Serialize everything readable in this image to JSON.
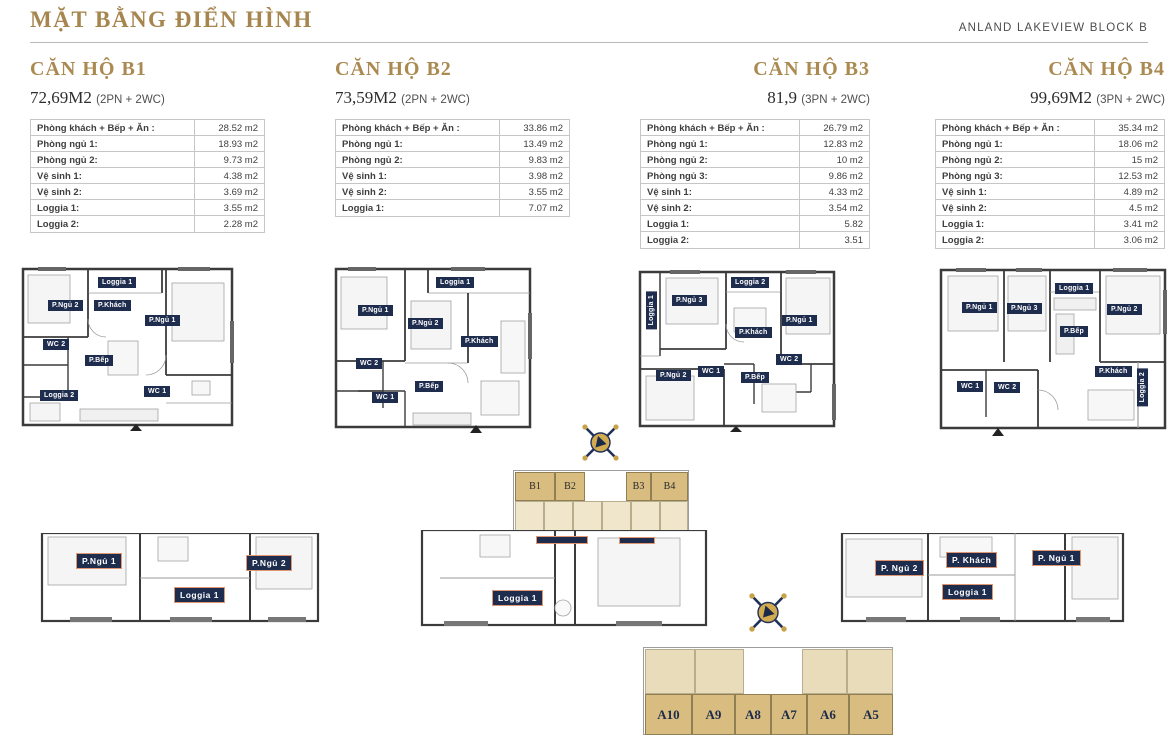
{
  "header": {
    "title": "MẶT BẰNG ĐIỂN HÌNH",
    "block_label": "ANLAND LAKEVIEW BLOCK B"
  },
  "colors": {
    "heading_gold": "#a6854e",
    "label_navy": "#1e2c4e",
    "keyplan_tan": "#d9bd80",
    "keyplan_pale": "#efe6cb"
  },
  "apartments": [
    {
      "name": "CĂN HỘ B1",
      "area": "72,69M2",
      "config": "(2PN + 2WC)",
      "rows": [
        {
          "label": "Phòng khách + Bếp + Ăn :",
          "value": "28.52 m2"
        },
        {
          "label": "Phòng ngủ 1:",
          "value": "18.93 m2"
        },
        {
          "label": "Phòng ngủ 2:",
          "value": "9.73 m2"
        },
        {
          "label": "Vệ sinh 1:",
          "value": "4.38 m2"
        },
        {
          "label": "Vệ sinh 2:",
          "value": "3.69 m2"
        },
        {
          "label": "Loggia 1:",
          "value": "3.55 m2"
        },
        {
          "label": "Loggia 2:",
          "value": "2.28 m2"
        }
      ]
    },
    {
      "name": "CĂN HỘ B2",
      "area": "73,59M2",
      "config": "(2PN + 2WC)",
      "rows": [
        {
          "label": "Phòng khách + Bếp + Ăn :",
          "value": "33.86 m2"
        },
        {
          "label": "Phòng ngủ 1:",
          "value": "13.49 m2"
        },
        {
          "label": "Phòng ngủ 2:",
          "value": "9.83 m2"
        },
        {
          "label": "Vệ sinh 1:",
          "value": "3.98 m2"
        },
        {
          "label": "Vệ sinh 2:",
          "value": "3.55 m2"
        },
        {
          "label": "Loggia 1:",
          "value": "7.07 m2"
        }
      ]
    },
    {
      "name": "CĂN HỘ B3",
      "area": "81,9",
      "config": "(3PN + 2WC)",
      "rows": [
        {
          "label": "Phòng khách + Bếp + Ăn :",
          "value": "26.79 m2"
        },
        {
          "label": "Phòng ngủ 1:",
          "value": "12.83 m2"
        },
        {
          "label": "Phòng ngủ 2:",
          "value": "10 m2"
        },
        {
          "label": "Phòng ngủ 3:",
          "value": "9.86 m2"
        },
        {
          "label": "Vệ sinh 1:",
          "value": "4.33 m2"
        },
        {
          "label": "Vệ sinh 2:",
          "value": "3.54 m2"
        },
        {
          "label": "Loggia 1:",
          "value": "5.82"
        },
        {
          "label": "Loggia 2:",
          "value": "3.51"
        }
      ]
    },
    {
      "name": "CĂN HỘ B4",
      "area": "99,69M2",
      "config": "(3PN + 2WC)",
      "rows": [
        {
          "label": "Phòng khách + Bếp + Ăn :",
          "value": "35.34 m2"
        },
        {
          "label": "Phòng ngủ 1:",
          "value": "18.06 m2"
        },
        {
          "label": "Phòng ngủ 2:",
          "value": "15 m2"
        },
        {
          "label": "Phòng ngủ 3:",
          "value": "12.53 m2"
        },
        {
          "label": "Vệ sinh 1:",
          "value": "4.89 m2"
        },
        {
          "label": "Vệ sinh 2:",
          "value": "4.5 m2"
        },
        {
          "label": "Loggia 1:",
          "value": "3.41 m2"
        },
        {
          "label": "Loggia 2:",
          "value": "3.06 m2"
        }
      ]
    }
  ],
  "plans": {
    "b1": {
      "loggia1": "Loggia 1",
      "pngu2": "P.Ngủ 2",
      "pkhach": "P.Khách",
      "pngu1": "P.Ngủ 1",
      "wc2": "WC 2",
      "pbep": "P.Bếp",
      "loggia2": "Loggia 2",
      "wc1": "WC 1"
    },
    "b2": {
      "pngu1": "P.Ngủ 1",
      "loggia1": "Loggia 1",
      "pngu2": "P.Ngủ 2",
      "pkhach": "P.Khách",
      "wc2": "WC 2",
      "wc1": "WC 1",
      "pbep": "P.Bếp"
    },
    "b3": {
      "loggia1": "Loggia 1",
      "pngu3": "P.Ngủ 3",
      "loggia2": "Loggia 2",
      "pngu1": "P.Ngủ 1",
      "pkhach": "P.Khách",
      "pngu2": "P.Ngủ 2",
      "wc1": "WC 1",
      "pbep": "P.Bếp",
      "wc2": "WC 2"
    },
    "b4": {
      "pngu1": "P.Ngủ 1",
      "pngu3": "P.Ngủ 3",
      "loggia1": "Loggia 1",
      "pngu2": "P.Ngủ 2",
      "pbep": "P.Bếp",
      "wc1": "WC 1",
      "wc2": "WC 2",
      "pkhach": "P.Khách",
      "loggia2": "Loggia 2"
    },
    "bottom_left": {
      "pngu1": "P.Ngủ 1",
      "loggia1": "Loggia 1",
      "pngu2": "P.Ngủ 2"
    },
    "bottom_center": {
      "loggia1": "Loggia 1"
    },
    "bottom_right": {
      "pngu2": "P. Ngủ 2",
      "pkhach": "P. Khách",
      "loggia1": "Loggia 1",
      "pngu1": "P. Ngủ 1"
    }
  },
  "keyplan_b": {
    "cells": [
      "B1",
      "B2",
      "B3",
      "B4"
    ]
  },
  "keyplan_a": {
    "cells": [
      "A10",
      "A9",
      "A8",
      "A7",
      "A6",
      "A5"
    ]
  }
}
